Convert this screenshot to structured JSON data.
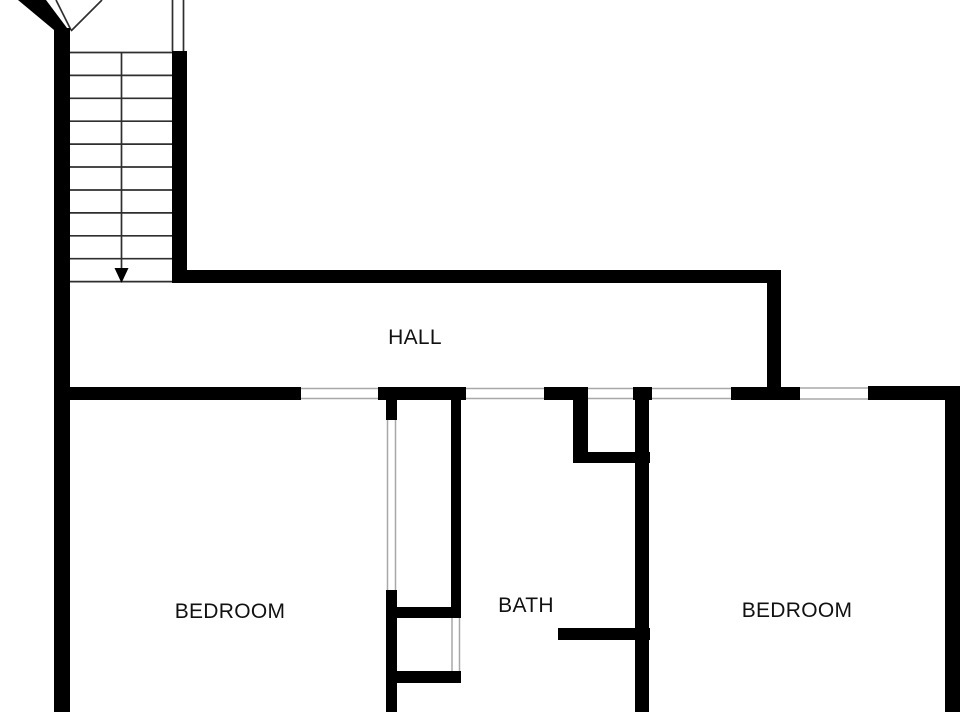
{
  "floor_plan": {
    "title": "Upper floor plan",
    "colors": {
      "background": "#ffffff",
      "wall": "#000000",
      "line": "#2f2f2f",
      "open": "#a8a8a8",
      "text": "#111111"
    },
    "rooms": [
      {
        "id": "hall",
        "label": "HALL",
        "cx": 415,
        "cy": 338
      },
      {
        "id": "bedroom-left",
        "label": "BEDROOM",
        "cx": 230,
        "cy": 612
      },
      {
        "id": "bath",
        "label": "BATH",
        "cx": 526,
        "cy": 606
      },
      {
        "id": "bedroom-right",
        "label": "BEDROOM",
        "cx": 797,
        "cy": 611
      }
    ],
    "stairs": {
      "direction_arrow": "down",
      "tread_count": 10
    },
    "geometry": {
      "walls": [
        {
          "name": "left-exterior-wall",
          "x": 54,
          "y": 28,
          "w": 16,
          "h": 684
        },
        {
          "name": "stair-side-wall",
          "x": 172,
          "y": 51,
          "w": 15,
          "h": 232
        },
        {
          "name": "hall-north-wall",
          "x": 172,
          "y": 270,
          "w": 609,
          "h": 13
        },
        {
          "name": "hall-east-wall",
          "x": 767,
          "y": 270,
          "w": 14,
          "h": 130
        },
        {
          "name": "bedroom-left-north-wall",
          "x": 54,
          "y": 387,
          "w": 247,
          "h": 13
        },
        {
          "name": "hall-south-wall-a",
          "x": 378,
          "y": 387,
          "w": 88,
          "h": 13
        },
        {
          "name": "hall-south-wall-b",
          "x": 544,
          "y": 387,
          "w": 44,
          "h": 13
        },
        {
          "name": "hall-south-wall-c",
          "x": 633,
          "y": 387,
          "w": 19,
          "h": 13
        },
        {
          "name": "hall-south-wall-d",
          "x": 731,
          "y": 387,
          "w": 69,
          "h": 13
        },
        {
          "name": "hall-south-wall-e",
          "x": 868,
          "y": 386,
          "w": 92,
          "h": 14
        },
        {
          "name": "right-exterior-wall",
          "x": 945,
          "y": 400,
          "w": 15,
          "h": 312
        },
        {
          "name": "closet-west-wall-upper",
          "x": 386,
          "y": 400,
          "w": 11,
          "h": 20
        },
        {
          "name": "closet-west-wall-lower",
          "x": 386,
          "y": 590,
          "w": 11,
          "h": 122
        },
        {
          "name": "closet-east-wall",
          "x": 451,
          "y": 387,
          "w": 10,
          "h": 231
        },
        {
          "name": "closet-south-wall",
          "x": 386,
          "y": 607,
          "w": 75,
          "h": 11
        },
        {
          "name": "lower-closet-south-wall",
          "x": 395,
          "y": 671,
          "w": 66,
          "h": 12
        },
        {
          "name": "linen-closet-west-wall",
          "x": 573,
          "y": 400,
          "w": 15,
          "h": 63
        },
        {
          "name": "linen-closet-south-wall",
          "x": 573,
          "y": 452,
          "w": 77,
          "h": 11
        },
        {
          "name": "bath-divider-wall",
          "x": 635,
          "y": 400,
          "w": 14,
          "h": 312
        },
        {
          "name": "bath-stub-wall",
          "x": 558,
          "y": 628,
          "w": 92,
          "h": 12
        }
      ],
      "polygons": [
        {
          "name": "exterior-wall-diagonal",
          "points": "18,0 46,0 70,32 70,46 54,46 54,30"
        },
        {
          "name": "stair-direction-arrow-head",
          "points": "114.5,268 128.5,268 121.5,283"
        }
      ],
      "lines": [
        {
          "name": "stair-tread",
          "x1": 70,
          "y1": 52.5,
          "x2": 172,
          "y2": 52.5
        },
        {
          "name": "stair-tread",
          "x1": 70,
          "y1": 75.4,
          "x2": 172,
          "y2": 75.4
        },
        {
          "name": "stair-tread",
          "x1": 70,
          "y1": 98.3,
          "x2": 172,
          "y2": 98.3
        },
        {
          "name": "stair-tread",
          "x1": 70,
          "y1": 121.2,
          "x2": 172,
          "y2": 121.2
        },
        {
          "name": "stair-tread",
          "x1": 70,
          "y1": 144.1,
          "x2": 172,
          "y2": 144.1
        },
        {
          "name": "stair-tread",
          "x1": 70,
          "y1": 167.0,
          "x2": 172,
          "y2": 167.0
        },
        {
          "name": "stair-tread",
          "x1": 70,
          "y1": 190.0,
          "x2": 172,
          "y2": 190.0
        },
        {
          "name": "stair-tread",
          "x1": 70,
          "y1": 212.9,
          "x2": 172,
          "y2": 212.9
        },
        {
          "name": "stair-tread",
          "x1": 70,
          "y1": 235.8,
          "x2": 172,
          "y2": 235.8
        },
        {
          "name": "stair-tread",
          "x1": 70,
          "y1": 258.7,
          "x2": 172,
          "y2": 258.7
        },
        {
          "name": "stair-tread",
          "x1": 70,
          "y1": 281.6,
          "x2": 172,
          "y2": 281.6
        },
        {
          "name": "stair-direction-arrow-shaft",
          "x1": 121.5,
          "y1": 52.5,
          "x2": 121.5,
          "y2": 271
        },
        {
          "name": "stair-wall-line",
          "x1": 172.5,
          "y1": 0,
          "x2": 172.5,
          "y2": 51
        },
        {
          "name": "stair-wall-line",
          "x1": 183.5,
          "y1": 0,
          "x2": 183.5,
          "y2": 51
        },
        {
          "name": "stair-break-line",
          "x1": 56,
          "y1": 0,
          "x2": 71,
          "y2": 30
        },
        {
          "name": "stair-break-line",
          "x1": 102,
          "y1": 0,
          "x2": 71,
          "y2": 31
        },
        {
          "name": "bedroom-left-door-opening",
          "c": "open",
          "x1": 301,
          "y1": 388.5,
          "x2": 378,
          "y2": 388.5
        },
        {
          "name": "bedroom-left-door-opening",
          "c": "open",
          "x1": 301,
          "y1": 398.5,
          "x2": 378,
          "y2": 398.5
        },
        {
          "name": "bath-door-opening",
          "c": "open",
          "x1": 466,
          "y1": 388.5,
          "x2": 544,
          "y2": 388.5
        },
        {
          "name": "bath-door-opening",
          "c": "open",
          "x1": 466,
          "y1": 398.5,
          "x2": 544,
          "y2": 398.5
        },
        {
          "name": "linen-closet-opening",
          "c": "open",
          "x1": 588,
          "y1": 388.5,
          "x2": 633,
          "y2": 388.5
        },
        {
          "name": "linen-closet-opening",
          "c": "open",
          "x1": 588,
          "y1": 398.5,
          "x2": 633,
          "y2": 398.5
        },
        {
          "name": "bedroom-right-door-opening",
          "c": "open",
          "x1": 652,
          "y1": 388.5,
          "x2": 731,
          "y2": 388.5
        },
        {
          "name": "bedroom-right-door-opening",
          "c": "open",
          "x1": 652,
          "y1": 398.5,
          "x2": 731,
          "y2": 398.5
        },
        {
          "name": "bedroom-right-window-opening",
          "c": "open",
          "x1": 800,
          "y1": 388,
          "x2": 868,
          "y2": 388
        },
        {
          "name": "bedroom-right-window-opening",
          "c": "open",
          "x1": 800,
          "y1": 399,
          "x2": 868,
          "y2": 399
        },
        {
          "name": "closet-door-opening",
          "c": "open",
          "x1": 387.5,
          "y1": 420,
          "x2": 387.5,
          "y2": 590
        },
        {
          "name": "closet-door-opening",
          "c": "open",
          "x1": 395.5,
          "y1": 420,
          "x2": 395.5,
          "y2": 590
        },
        {
          "name": "lower-closet-opening",
          "c": "open",
          "x1": 452,
          "y1": 618,
          "x2": 452,
          "y2": 671
        },
        {
          "name": "lower-closet-opening",
          "c": "open",
          "x1": 459.5,
          "y1": 618,
          "x2": 459.5,
          "y2": 671
        }
      ]
    }
  }
}
